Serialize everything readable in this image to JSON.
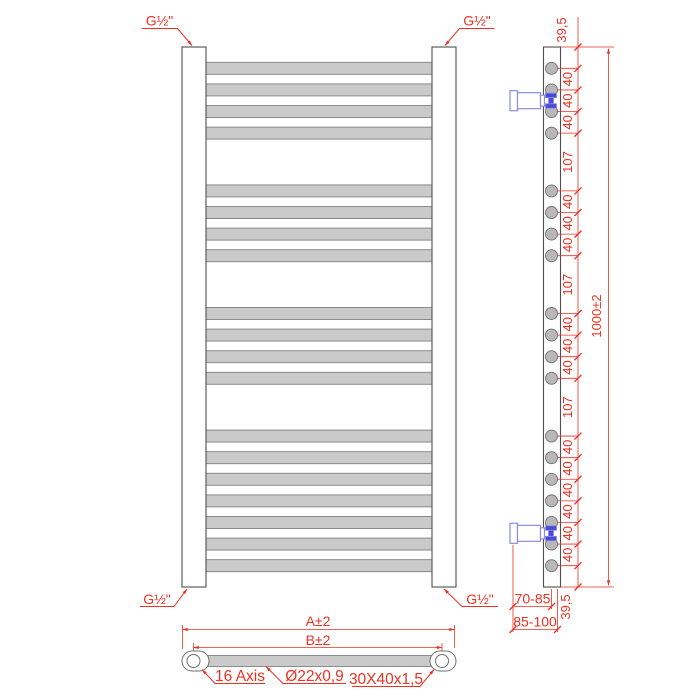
{
  "front_view": {
    "fitting_labels": {
      "top_left": "G½\"",
      "top_right": "G½\"",
      "bottom_left": "G½\"",
      "bottom_right": "G½\""
    }
  },
  "side_view": {
    "dimension_chain": [
      "39,5",
      "40",
      "40",
      "40",
      "107",
      "40",
      "40",
      "40",
      "107",
      "40",
      "40",
      "40",
      "107",
      "40",
      "40",
      "40",
      "40",
      "40",
      "40",
      "39,5"
    ],
    "overall_height": "1000±2",
    "wall_distance_min": "70-85",
    "wall_distance_max": "85-100"
  },
  "bottom_view": {
    "overall_width": "A±2",
    "axis_width": "B±2",
    "axis_note": "16 Axis",
    "tube_spec": "Ø22x0,9",
    "profile_spec": "30X40x1,5"
  },
  "colors": {
    "dimension": "#ed3123",
    "tube_fill": "#cacaca",
    "tube_stroke": "#828282",
    "profile_stroke": "#4f4f4f",
    "section_fill": "#b8b8b8",
    "valve_outline": "#8c8cdd",
    "valve_fill": "#4a4ad8"
  }
}
